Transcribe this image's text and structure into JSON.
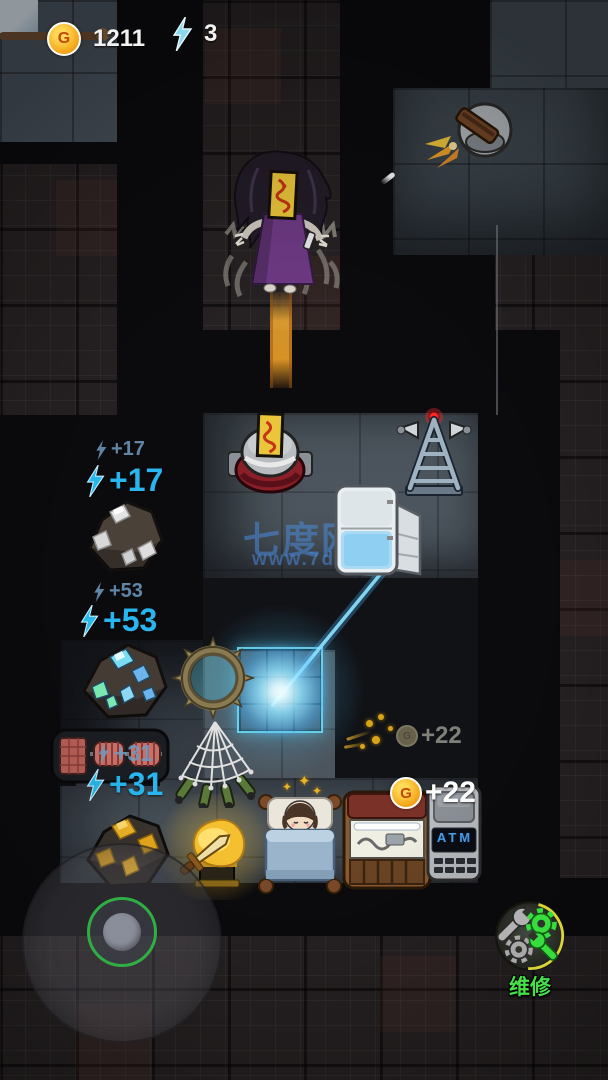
{
  "hud": {
    "gold_amount": "1211",
    "gold_letter": "G",
    "energy_amount": "3"
  },
  "watermark": {
    "title": "七度网",
    "url": "www.7do.net"
  },
  "floats": {
    "energy17_old": "+17",
    "energy17_new": "+17",
    "energy53_old": "+53",
    "energy53_new": "+53",
    "energy31_old": "+31",
    "energy31_new": "+31",
    "gold22_old": "+22",
    "gold22_new": "+22",
    "coin_letter": "G",
    "coin_letter_faded": "G"
  },
  "buttons": {
    "repair_label": "维修"
  },
  "objects": {
    "atm_label": "ATM"
  },
  "colors": {
    "energy_blue": "#27b6ef",
    "gold": "#f4a81c",
    "repair_green": "#46e048",
    "watermark_blue": "#488adc",
    "orb_cyan": "#73e1f8"
  }
}
